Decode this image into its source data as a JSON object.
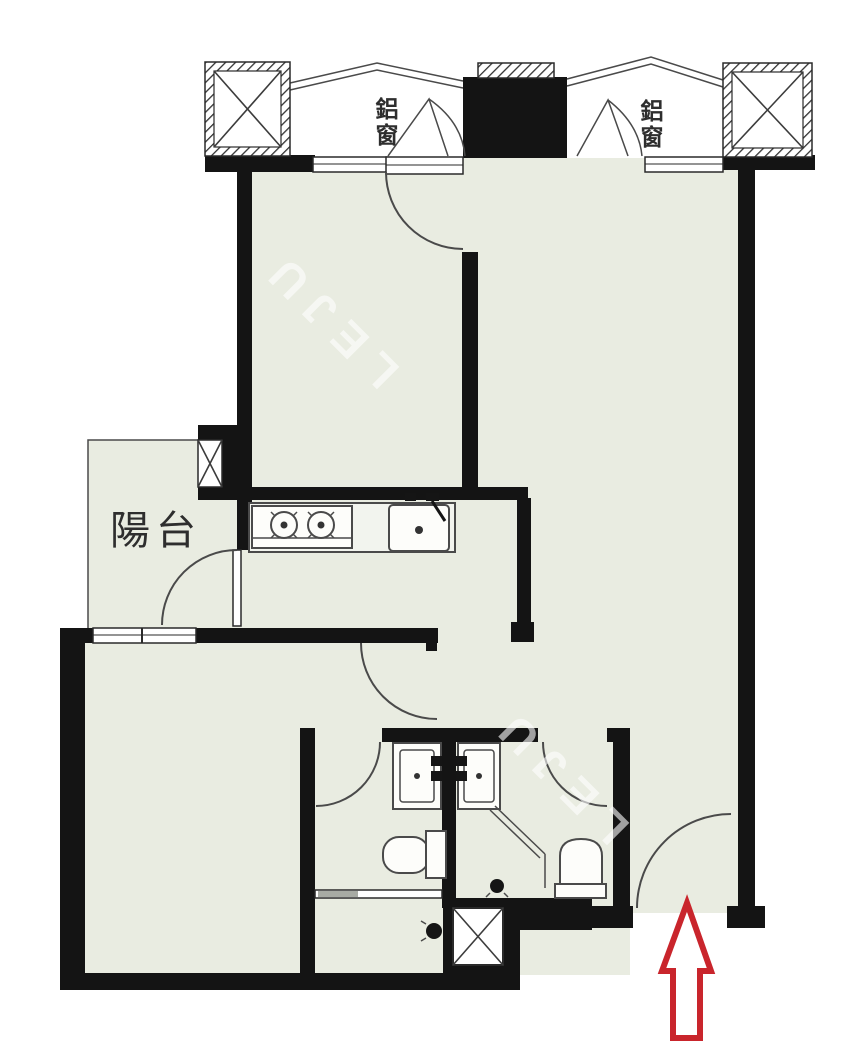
{
  "floorplan": {
    "labels": {
      "balcony": "陽台",
      "window_left": "鋁窗",
      "window_right": "鋁窗"
    },
    "watermark": {
      "text": "LEJU"
    },
    "colors": {
      "floor": "#e9ece1",
      "wall": "#141414",
      "line": "#4a4a4a",
      "arrow": "#c9252c",
      "background": "#ffffff",
      "label": "#2e2e2e",
      "watermark": "rgba(255,255,255,0.6)"
    },
    "icons": {
      "entry_arrow": "up-arrow-entrance-marker",
      "columns": "hatched-x-column",
      "shaft": "x-crossed-pipe-shaft"
    }
  }
}
